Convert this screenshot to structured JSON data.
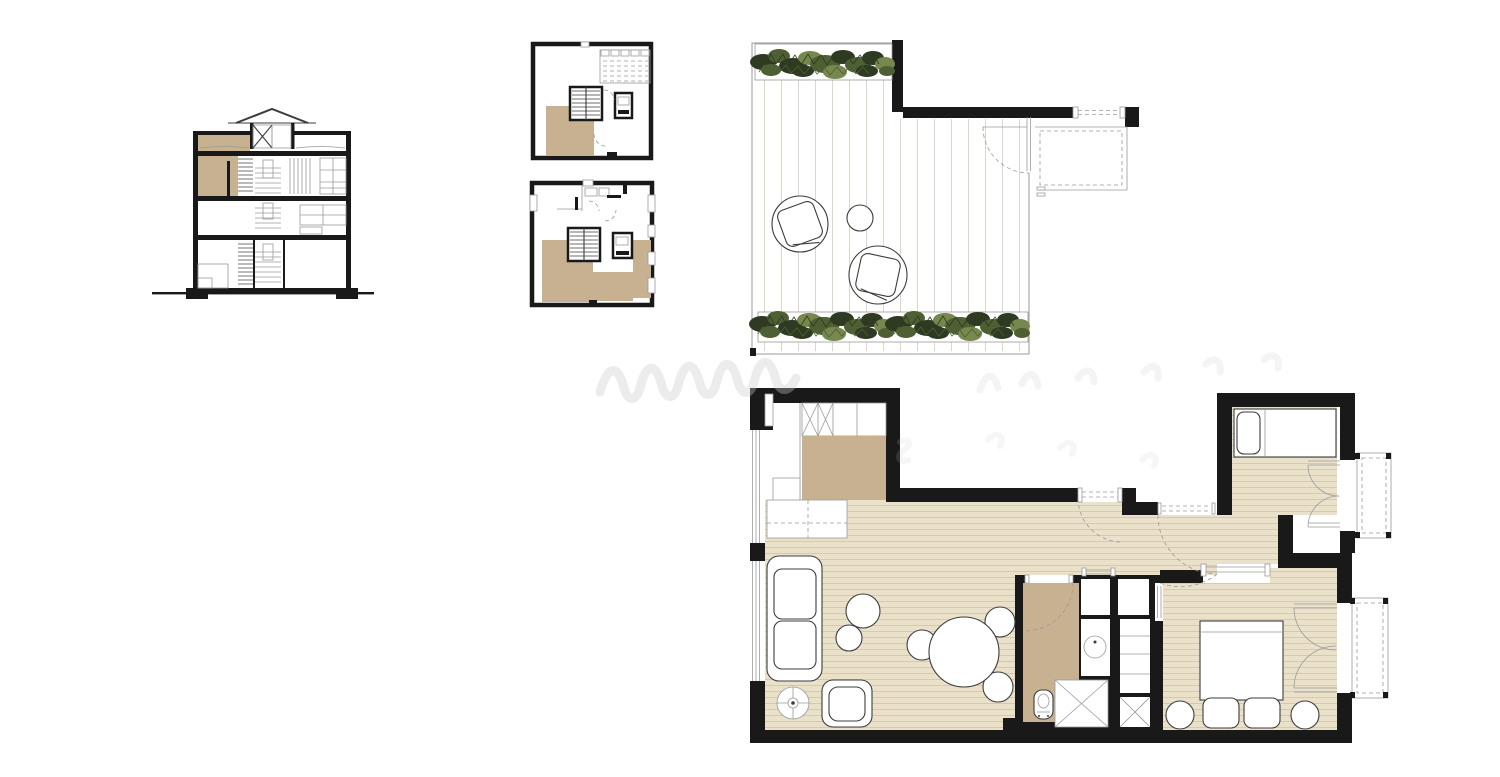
{
  "document": {
    "sheet_type": "architectural-drawing-set",
    "background": "#ffffff",
    "visible_text": "",
    "description": "Drawing sheet with building cross-section, two key floor plans, roof terrace plan and furnished apartment floor plan; apartment unit highlighted in tan"
  },
  "colors": {
    "paper": "#ffffff",
    "wall": "#191919",
    "line": "#3c3c3c",
    "thin": "#9a9a9a",
    "tan": "#c8b190",
    "floor": "#eae1ca",
    "stripe": "#d6c9ad",
    "deck": "#dcd8c8",
    "plant_dark": "#2e3a21",
    "plant_mid": "#4e5f33",
    "plant_light": "#76884e",
    "watermark": "#c9c9c9"
  },
  "figures": {
    "building_section": {
      "name": "building-section",
      "elements": [
        "pitched-roof-dormer",
        "three-floor-slabs",
        "staircase",
        "highlighted-attic-room",
        "highlighted-upper-room",
        "ground-line"
      ]
    },
    "key_plan_upper": {
      "name": "key-plan-upper-floor",
      "elements": [
        "stair-core",
        "elevator",
        "roof-terrace-hatch",
        "highlighted-unit-area"
      ]
    },
    "key_plan_lower": {
      "name": "key-plan-lower-floor",
      "elements": [
        "stair-core",
        "elevator",
        "windows",
        "highlighted-unit-areas"
      ]
    },
    "terrace_plan": {
      "name": "roof-terrace-plan",
      "elements": [
        "planter-top",
        "planter-bottom",
        "deck-boards",
        "lounge-chair-1",
        "lounge-chair-2",
        "side-table",
        "terrace-door",
        "balcony-railing"
      ]
    },
    "apartment_plan": {
      "name": "apartment-floor-plan",
      "rooms": [
        "kitchen",
        "living-dining-room",
        "hallway",
        "bathroom",
        "closets",
        "small-bedroom",
        "main-bedroom",
        "balcony-small",
        "balcony-main"
      ],
      "furniture": [
        "kitchen-cabinets",
        "kitchen-counter",
        "desk",
        "sofa",
        "armchair",
        "floor-lamp",
        "coffee-tables",
        "dining-table",
        "dining-chairs",
        "toilet",
        "shower",
        "washbasin",
        "washing-machine",
        "single-bed",
        "double-bed",
        "nightstands"
      ]
    }
  }
}
